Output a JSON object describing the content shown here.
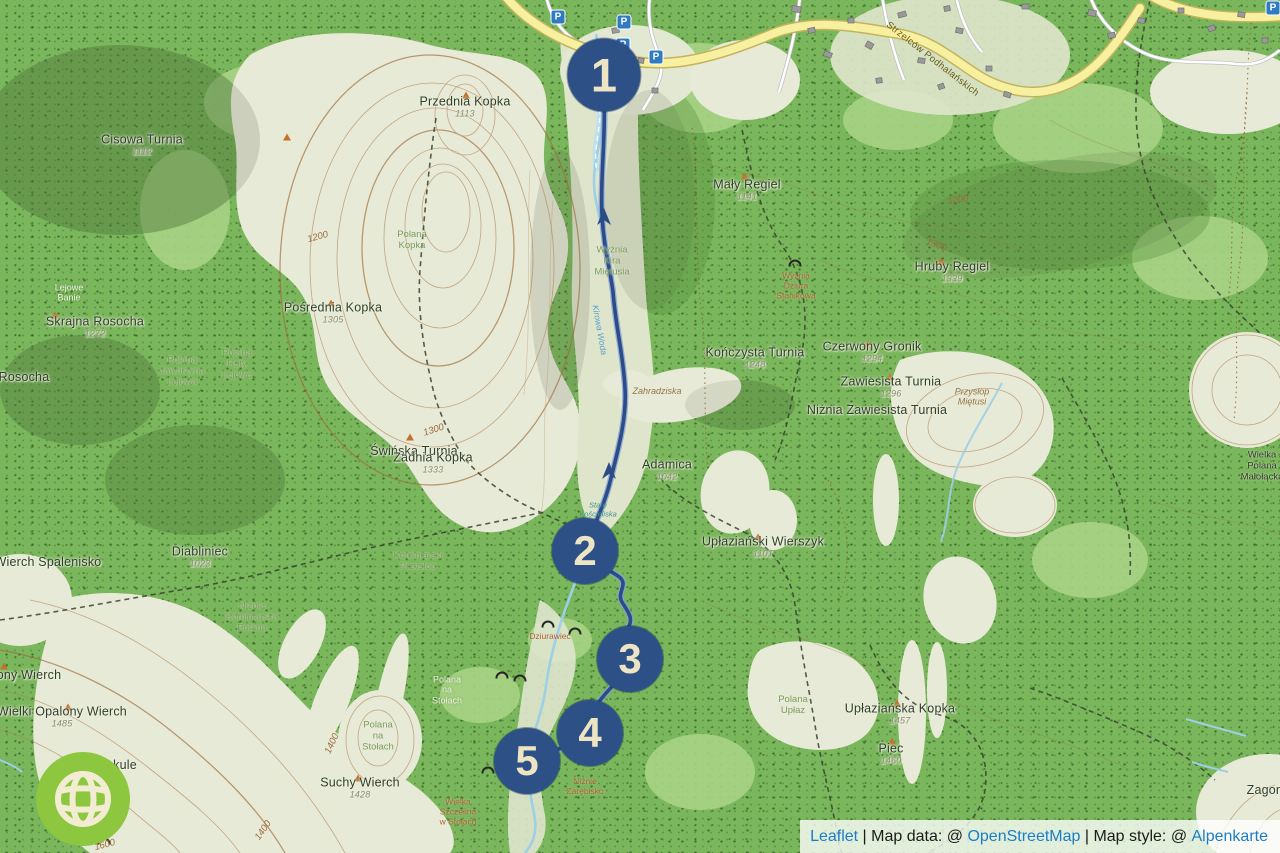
{
  "attribution": {
    "leaflet": "Leaflet",
    "sep1": " | ",
    "data_prefix": "Map data: @ ",
    "osm": "OpenStreetMap",
    "sep2": " | ",
    "style_prefix": "Map style: @ ",
    "style_link": "Alpenkarte"
  },
  "colors": {
    "forest_green": "#7ab65b",
    "open_terrain": "#e7ead6",
    "marker_blue": "#2d5187",
    "marker_text_cream": "#ede4c4",
    "road_yellow": "#f7f0a0",
    "stream_blue": "#9dcfe6",
    "route_navy": "#2b4c86",
    "parking_blue": "#2f7ac2",
    "logo_green": "#8dc63f",
    "link_blue": "#1b7dc4"
  },
  "map": {
    "parking_label": "P",
    "markers": [
      {
        "n": "1",
        "x": 604,
        "y": 75,
        "d": 73
      },
      {
        "n": "2",
        "x": 585,
        "y": 551,
        "d": 66
      },
      {
        "n": "3",
        "x": 630,
        "y": 659,
        "d": 66
      },
      {
        "n": "4",
        "x": 590,
        "y": 733,
        "d": 66
      },
      {
        "n": "5",
        "x": 527,
        "y": 761,
        "d": 66
      }
    ],
    "parking": [
      {
        "x": 558,
        "y": 17
      },
      {
        "x": 624,
        "y": 22
      },
      {
        "x": 623,
        "y": 45
      },
      {
        "x": 656,
        "y": 57
      },
      {
        "x": 1273,
        "y": 8
      }
    ],
    "labels": [
      {
        "t": "Cisowa Turnia",
        "x": 142,
        "y": 145,
        "c": "peak",
        "s": "1112"
      },
      {
        "t": "Przednia Kopka",
        "x": 465,
        "y": 107,
        "c": "peak",
        "s": "1113"
      },
      {
        "t": "Mały Regiel",
        "x": 747,
        "y": 190,
        "c": "peak",
        "s": "1141"
      },
      {
        "t": "Hruby Regiel",
        "x": 952,
        "y": 272,
        "c": "peak",
        "s": "1339"
      },
      {
        "t": "Skrajna Rosocha",
        "x": 95,
        "y": 327,
        "c": "peak",
        "s": "1272"
      },
      {
        "t": "Rosocha",
        "x": 24,
        "y": 377,
        "c": "peak"
      },
      {
        "t": "Pośrednia Kopka",
        "x": 333,
        "y": 313,
        "c": "peak",
        "s": "1305"
      },
      {
        "t": "Kończysta Turnia",
        "x": 755,
        "y": 358,
        "c": "peak",
        "s": "1248"
      },
      {
        "t": "Czerwony Gronik",
        "x": 872,
        "y": 352,
        "c": "peak",
        "s": "1294"
      },
      {
        "t": "Zawiesista Turnia",
        "x": 891,
        "y": 387,
        "c": "peak",
        "s": "1296"
      },
      {
        "t": "Niżnia Zawiesista Turnia",
        "x": 877,
        "y": 410,
        "c": "peak"
      },
      {
        "t": "Świńska Turnia",
        "x": 414,
        "y": 451,
        "c": "peak"
      },
      {
        "t": "Zadnia Kopka",
        "x": 433,
        "y": 463,
        "c": "peak",
        "s": "1333"
      },
      {
        "t": "Adamica",
        "x": 667,
        "y": 470,
        "c": "peak",
        "s": "1042"
      },
      {
        "t": "Upłaziański Wierszyk",
        "x": 763,
        "y": 547,
        "c": "peak",
        "s": "1101"
      },
      {
        "t": "Diabliniec",
        "x": 200,
        "y": 557,
        "c": "peak",
        "s": "1023"
      },
      {
        "t": "Wierch Spalenisko",
        "x": 48,
        "y": 562,
        "c": "peak"
      },
      {
        "t": "ony Wierch",
        "x": 29,
        "y": 675,
        "c": "peak"
      },
      {
        "t": "Wielki Opalony Wierch",
        "x": 62,
        "y": 717,
        "c": "peak",
        "s": "1485"
      },
      {
        "t": "Suchy Wierch",
        "x": 360,
        "y": 788,
        "c": "peak",
        "s": "1428"
      },
      {
        "t": "Upłaziańska Kopka",
        "x": 900,
        "y": 714,
        "c": "peak",
        "s": "1457"
      },
      {
        "t": "Piec",
        "x": 891,
        "y": 754,
        "c": "peak",
        "s": "1460"
      },
      {
        "t": "Zagonna",
        "x": 1272,
        "y": 790,
        "c": "peak"
      },
      {
        "t": "kule",
        "x": 125,
        "y": 765,
        "c": "peak"
      },
      {
        "t": "Wielka\nPolana\nMałołącka",
        "x": 1262,
        "y": 467,
        "c": "peak-sm"
      },
      {
        "t": "Polana\nKopka",
        "x": 412,
        "y": 241,
        "c": "polana"
      },
      {
        "t": "Polana\nJaworzyna\nLejowa",
        "x": 182,
        "y": 372,
        "c": "polana"
      },
      {
        "t": "Polana\nHuty\nLejowe",
        "x": 237,
        "y": 365,
        "c": "polana"
      },
      {
        "t": "Niżnia\nKominiarska\nPolana",
        "x": 252,
        "y": 618,
        "c": "polana"
      },
      {
        "t": "Kominiarski\nPrzysłop",
        "x": 418,
        "y": 562,
        "c": "polana"
      },
      {
        "t": "Polana\nna\nStołach",
        "x": 378,
        "y": 737,
        "c": "polana"
      },
      {
        "t": "Polana\nUpłaz",
        "x": 793,
        "y": 706,
        "c": "polana"
      },
      {
        "t": "Wyżnia\nKira\nMiętusia",
        "x": 612,
        "y": 262,
        "c": "polana"
      },
      {
        "t": "Lejowe\nBanie",
        "x": 69,
        "y": 293,
        "c": "polana-white"
      },
      {
        "t": "Polana\nna\nStołach",
        "x": 447,
        "y": 690,
        "c": "polana-white"
      },
      {
        "t": "Wyżnia\nDziura\nStanikowa",
        "x": 796,
        "y": 286,
        "c": "cave"
      },
      {
        "t": "Dziurawiec",
        "x": 550,
        "y": 637,
        "c": "cave"
      },
      {
        "t": "Niżnie\nZarębisko",
        "x": 585,
        "y": 787,
        "c": "cave"
      },
      {
        "t": "Wielka\nSzczelina\nw Stołach",
        "x": 458,
        "y": 812,
        "c": "cave"
      },
      {
        "t": "Zahradziska",
        "x": 657,
        "y": 391,
        "c": "terrain"
      },
      {
        "t": "Przysłop\nMiętusi",
        "x": 972,
        "y": 397,
        "c": "terrain"
      },
      {
        "t": "Kirowa Woda",
        "x": 599,
        "y": 330,
        "c": "water",
        "r": 80
      },
      {
        "t": "Stare\nKościeliska",
        "x": 598,
        "y": 510,
        "c": "hist"
      },
      {
        "t": "Strzelców Podhalańskich",
        "x": 932,
        "y": 60,
        "c": "roadlbl",
        "r": 38
      },
      {
        "t": "1200",
        "x": 318,
        "y": 238,
        "c": "contour",
        "r": -15
      },
      {
        "t": "1200",
        "x": 958,
        "y": 201,
        "c": "contour",
        "r": -8
      },
      {
        "t": "1300",
        "x": 936,
        "y": 246,
        "c": "contour",
        "r": 22
      },
      {
        "t": "1300",
        "x": 434,
        "y": 431,
        "c": "contour",
        "r": -18
      },
      {
        "t": "1400",
        "x": 333,
        "y": 744,
        "c": "contour",
        "r": -65
      },
      {
        "t": "1400",
        "x": 264,
        "y": 831,
        "c": "contour",
        "r": -55
      },
      {
        "t": "1600",
        "x": 105,
        "y": 846,
        "c": "contour",
        "r": -15
      }
    ],
    "peak_triangles": [
      {
        "x": 466,
        "y": 95
      },
      {
        "x": 287,
        "y": 137
      },
      {
        "x": 55,
        "y": 315
      },
      {
        "x": 331,
        "y": 303
      },
      {
        "x": 410,
        "y": 437
      },
      {
        "x": 745,
        "y": 176
      },
      {
        "x": 941,
        "y": 261
      },
      {
        "x": 868,
        "y": 344
      },
      {
        "x": 890,
        "y": 377
      },
      {
        "x": 758,
        "y": 537
      },
      {
        "x": 897,
        "y": 703
      },
      {
        "x": 892,
        "y": 741
      },
      {
        "x": 358,
        "y": 778
      },
      {
        "x": 68,
        "y": 707
      },
      {
        "x": 4,
        "y": 666
      }
    ],
    "cave_symbols": [
      {
        "x": 795,
        "y": 263
      },
      {
        "x": 548,
        "y": 624
      },
      {
        "x": 502,
        "y": 675
      },
      {
        "x": 520,
        "y": 678
      },
      {
        "x": 575,
        "y": 631
      },
      {
        "x": 488,
        "y": 770
      },
      {
        "x": 104,
        "y": 841
      }
    ]
  }
}
